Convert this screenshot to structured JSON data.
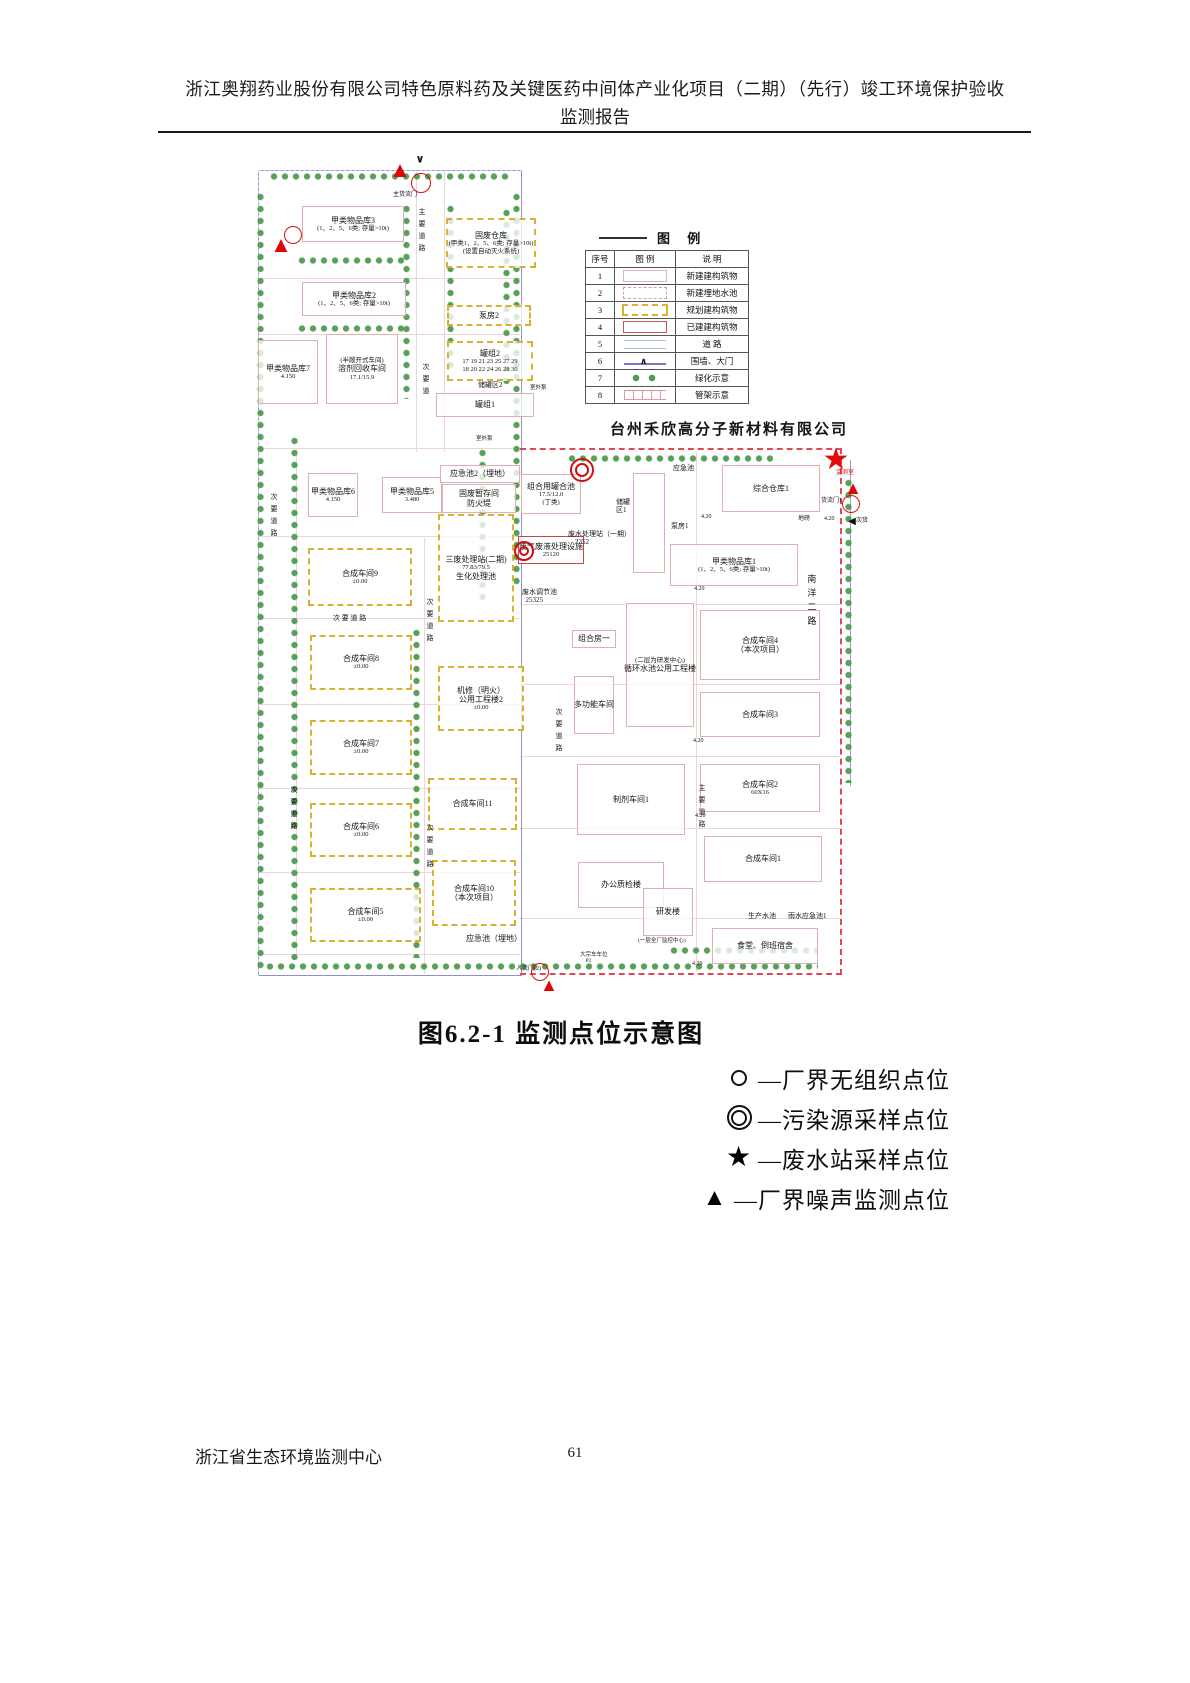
{
  "header": {
    "line1": "浙江奥翔药业股份有限公司特色原料药及关键医药中间体产业化项目（二期）（先行）竣工环境保护验收",
    "line2": "监测报告"
  },
  "caption": "图6.2-1  监测点位示意图",
  "footer": {
    "org": "浙江省生态环境监测中心",
    "page": "61"
  },
  "point_legend": [
    {
      "sym": "circle",
      "label": "—厂界无组织点位"
    },
    {
      "sym": "double",
      "label": "—污染源采样点位"
    },
    {
      "sym": "star",
      "label": "—废水站采样点位"
    },
    {
      "sym": "triangle",
      "label": "—厂界噪声监测点位"
    }
  ],
  "map": {
    "company": "台州禾欣高分子新材料有限公司",
    "colors": {
      "boundary_blue": "#8f8fca",
      "boundary_red": "#e04858",
      "planned_yellow": "#d6b232",
      "new_building_pink": "#dfb0b0",
      "existing_red": "#cc4444",
      "marker_red": "#dd1010",
      "tree_green": "#4f9b4f"
    },
    "legend": {
      "title": "图  例",
      "headers": [
        "序号",
        "图  例",
        "说  明"
      ],
      "rows": [
        {
          "n": "1",
          "s": "new",
          "d": "新建建构筑物"
        },
        {
          "n": "2",
          "s": "pool",
          "d": "新建埋地水池"
        },
        {
          "n": "3",
          "s": "planned",
          "d": "规划建构筑物"
        },
        {
          "n": "4",
          "s": "built",
          "d": "已建建构筑物"
        },
        {
          "n": "5",
          "s": "road",
          "d": "道  路"
        },
        {
          "n": "6",
          "s": "wall",
          "d": "围墙、大门"
        },
        {
          "n": "7",
          "s": "green",
          "d": "绿化示意"
        },
        {
          "n": "8",
          "s": "pipe",
          "d": "管架示意"
        }
      ]
    },
    "buildings": [
      {
        "x": 52,
        "y": 58,
        "w": 100,
        "h": 34,
        "st": "new",
        "ls": [
          "甲类物品库3",
          "(1、2、5、6类; 存量>10t)"
        ]
      },
      {
        "x": 196,
        "y": 70,
        "w": 86,
        "h": 46,
        "st": "planned",
        "ls": [
          "固废仓库",
          "(甲类1、2、5、6类; 存量>10t)",
          "(设置自动灭火系统)"
        ]
      },
      {
        "x": 52,
        "y": 134,
        "w": 102,
        "h": 32,
        "st": "new",
        "ls": [
          "甲类物品库2",
          "(1、2、5、6类; 存量>10t)"
        ]
      },
      {
        "x": 197,
        "y": 157,
        "w": 80,
        "h": 17,
        "st": "planned",
        "ls": [
          "泵房2"
        ]
      },
      {
        "x": 197,
        "y": 193,
        "w": 82,
        "h": 36,
        "st": "planned",
        "ls": [
          "罐组2",
          "17 19 21 23 25 27 29",
          "18 20 22 24 26 28 30"
        ]
      },
      {
        "x": 186,
        "y": 245,
        "w": 96,
        "h": 22,
        "st": "new",
        "ls": [
          "罐组1"
        ]
      },
      {
        "x": 8,
        "y": 192,
        "w": 58,
        "h": 62,
        "st": "new",
        "ls": [
          "甲类物品库7",
          "4.150"
        ]
      },
      {
        "x": 76,
        "y": 186,
        "w": 70,
        "h": 68,
        "st": "new",
        "ls": [
          "(半敞开式车间)",
          "溶剂回收车间",
          "17.1/15.9"
        ]
      },
      {
        "x": 58,
        "y": 325,
        "w": 48,
        "h": 42,
        "st": "new",
        "ls": [
          "甲类物品库6",
          "4.150"
        ]
      },
      {
        "x": 132,
        "y": 329,
        "w": 58,
        "h": 34,
        "st": "new",
        "ls": [
          "甲类物品库5",
          "3.480"
        ]
      },
      {
        "x": 190,
        "y": 317,
        "w": 78,
        "h": 16,
        "st": "new",
        "ls": [
          "应急池2（埋地）"
        ]
      },
      {
        "x": 192,
        "y": 336,
        "w": 72,
        "h": 27,
        "st": "new",
        "ls": [
          "固废暂存间",
          "防火堤"
        ]
      },
      {
        "x": 188,
        "y": 366,
        "w": 72,
        "h": 104,
        "st": "planned",
        "ls": [
          "三废处理站(二期)",
          "77.83/79.5",
          "生化处理池"
        ]
      },
      {
        "x": 58,
        "y": 400,
        "w": 100,
        "h": 54,
        "st": "planned",
        "ls": [
          "合成车间9",
          "±0.00"
        ]
      },
      {
        "x": 60,
        "y": 487,
        "w": 98,
        "h": 51,
        "st": "planned",
        "ls": [
          "合成车间8",
          "±0.00"
        ]
      },
      {
        "x": 60,
        "y": 572,
        "w": 98,
        "h": 51,
        "st": "planned",
        "ls": [
          "合成车间7",
          "±0.00"
        ]
      },
      {
        "x": 60,
        "y": 655,
        "w": 98,
        "h": 50,
        "st": "planned",
        "ls": [
          "合成车间6",
          "±0.00"
        ]
      },
      {
        "x": 60,
        "y": 740,
        "w": 107,
        "h": 50,
        "st": "planned",
        "ls": [
          "合成车间5",
          "±0.00"
        ]
      },
      {
        "x": 188,
        "y": 518,
        "w": 82,
        "h": 61,
        "st": "planned",
        "ls": [
          "机修（明火）",
          "公用工程楼2",
          "±0.00"
        ]
      },
      {
        "x": 178,
        "y": 630,
        "w": 85,
        "h": 48,
        "st": "planned",
        "ls": [
          "合成车间11"
        ]
      },
      {
        "x": 182,
        "y": 712,
        "w": 80,
        "h": 62,
        "st": "planned",
        "ls": [
          "合成车间10",
          "（本次项目）"
        ]
      },
      {
        "x": 196,
        "y": 783,
        "w": 96,
        "h": 16,
        "st": "plain",
        "ls": [
          "应急池（埋地）"
        ]
      },
      {
        "x": 472,
        "y": 317,
        "w": 96,
        "h": 45,
        "st": "new",
        "ls": [
          "综合仓库1"
        ]
      },
      {
        "x": 420,
        "y": 396,
        "w": 126,
        "h": 40,
        "st": "new",
        "ls": [
          "甲类物品库1",
          "(1、2、5、6类; 存量>10t)"
        ]
      },
      {
        "x": 450,
        "y": 462,
        "w": 118,
        "h": 68,
        "st": "new",
        "ls": [
          "合成车间4",
          "（本次项目）"
        ]
      },
      {
        "x": 450,
        "y": 544,
        "w": 118,
        "h": 43,
        "st": "new",
        "ls": [
          "合成车间3"
        ]
      },
      {
        "x": 450,
        "y": 616,
        "w": 118,
        "h": 46,
        "st": "new",
        "ls": [
          "合成车间2",
          "60X16"
        ]
      },
      {
        "x": 454,
        "y": 688,
        "w": 116,
        "h": 44,
        "st": "new",
        "ls": [
          "合成车间1"
        ]
      },
      {
        "x": 327,
        "y": 616,
        "w": 106,
        "h": 69,
        "st": "new",
        "ls": [
          "制剂车间1"
        ]
      },
      {
        "x": 324,
        "y": 528,
        "w": 38,
        "h": 56,
        "st": "new",
        "ls": [
          "多功能车间"
        ]
      },
      {
        "x": 376,
        "y": 455,
        "w": 66,
        "h": 122,
        "st": "new",
        "ls": [
          "(二层为研发中心)",
          "循环水池公用工程楼"
        ]
      },
      {
        "x": 322,
        "y": 482,
        "w": 42,
        "h": 16,
        "st": "new",
        "ls": [
          "组合房一"
        ]
      },
      {
        "x": 328,
        "y": 714,
        "w": 84,
        "h": 44,
        "st": "new",
        "ls": [
          "办公质检楼"
        ]
      },
      {
        "x": 393,
        "y": 740,
        "w": 48,
        "h": 46,
        "st": "new",
        "ls": [
          "研发楼"
        ]
      },
      {
        "x": 462,
        "y": 780,
        "w": 104,
        "h": 34,
        "st": "new",
        "ls": [
          "食堂、倒班宿舍"
        ]
      },
      {
        "x": 383,
        "y": 325,
        "w": 30,
        "h": 98,
        "st": "new",
        "ls": []
      },
      {
        "x": 271,
        "y": 326,
        "w": 58,
        "h": 38,
        "st": "new",
        "ls": [
          "组合用罐合池",
          "17.5/12.0",
          "(丁类)"
        ]
      },
      {
        "x": 268,
        "y": 388,
        "w": 64,
        "h": 26,
        "st": "existing",
        "ls": [
          "废气废液处理设施",
          "25120"
        ]
      }
    ],
    "labels": [
      {
        "t": "主货流门",
        "x": 143,
        "y": 44,
        "s": 6
      },
      {
        "t": "主要道路",
        "x": 168,
        "y": 60,
        "s": 7,
        "v": 1
      },
      {
        "t": "次要道",
        "x": 172,
        "y": 215,
        "s": 7,
        "v": 1
      },
      {
        "t": "次要道路",
        "x": 20,
        "y": 345,
        "s": 7,
        "v": 1
      },
      {
        "t": "次 要 道 路",
        "x": 83,
        "y": 466,
        "s": 7
      },
      {
        "t": "次要道路",
        "x": 176,
        "y": 450,
        "s": 7,
        "v": 1
      },
      {
        "t": "次要道路",
        "x": 40,
        "y": 638,
        "s": 7,
        "v": 1
      },
      {
        "t": "次要道路",
        "x": 176,
        "y": 676,
        "s": 7,
        "v": 1
      },
      {
        "t": "次要道路",
        "x": 305,
        "y": 560,
        "s": 7,
        "v": 1
      },
      {
        "t": "主要道路",
        "x": 448,
        "y": 636,
        "s": 7,
        "v": 1
      },
      {
        "t": "南洋二路",
        "x": 556,
        "y": 426,
        "s": 9,
        "v": 1
      },
      {
        "t": "储罐区2",
        "x": 228,
        "y": 233,
        "s": 7
      },
      {
        "t": "室外泵",
        "x": 280,
        "y": 237,
        "s": 5.5
      },
      {
        "t": "室外泵",
        "x": 226,
        "y": 288,
        "s": 5.5
      },
      {
        "t": "应急池",
        "x": 423,
        "y": 316,
        "s": 7
      },
      {
        "t": "泵房1",
        "x": 421,
        "y": 374,
        "s": 7
      },
      {
        "t": "储罐\n区1",
        "x": 366,
        "y": 350,
        "s": 7
      },
      {
        "t": "废水处理站（一期）\n    2352",
        "x": 318,
        "y": 382,
        "s": 7
      },
      {
        "t": "废水调节池\n  25325",
        "x": 272,
        "y": 440,
        "s": 7
      },
      {
        "t": "4.20",
        "x": 451,
        "y": 366,
        "s": 6
      },
      {
        "t": "地磅",
        "x": 548,
        "y": 368,
        "s": 6
      },
      {
        "t": "4.20",
        "x": 574,
        "y": 368,
        "s": 6
      },
      {
        "t": "4.20",
        "x": 444,
        "y": 438,
        "s": 6
      },
      {
        "t": "4.20",
        "x": 443,
        "y": 590,
        "s": 6
      },
      {
        "t": "4.20",
        "x": 445,
        "y": 665,
        "s": 6
      },
      {
        "t": "4.20",
        "x": 442,
        "y": 813,
        "s": 6
      },
      {
        "t": "监测室",
        "x": 586,
        "y": 322,
        "s": 6,
        "red": 1
      },
      {
        "t": "货流门1",
        "x": 571,
        "y": 350,
        "s": 6
      },
      {
        "t": "次货",
        "x": 606,
        "y": 370,
        "s": 6
      },
      {
        "t": "人流门(2)",
        "x": 266,
        "y": 818,
        "s": 6
      },
      {
        "t": "大宗车车位\n    P2",
        "x": 330,
        "y": 804,
        "s": 5.5
      },
      {
        "t": "生产水池",
        "x": 498,
        "y": 764,
        "s": 7
      },
      {
        "t": "雨水应急池1",
        "x": 538,
        "y": 764,
        "s": 7
      },
      {
        "t": "(一层全厂监控中心)",
        "x": 388,
        "y": 790,
        "s": 5.5
      }
    ],
    "markers": [
      {
        "ty": "tri",
        "x": 150,
        "y": 22,
        "s": 22
      },
      {
        "ty": "vdown",
        "x": 170,
        "y": 12
      },
      {
        "ty": "circ",
        "x": 171,
        "y": 35,
        "r": 9
      },
      {
        "ty": "tri",
        "x": 31,
        "y": 97,
        "s": 22
      },
      {
        "ty": "circ",
        "x": 43,
        "y": 87,
        "r": 8
      },
      {
        "ty": "dbl",
        "x": 332,
        "y": 322,
        "r": 10
      },
      {
        "ty": "dbl",
        "x": 274,
        "y": 403,
        "r": 8
      },
      {
        "ty": "star",
        "x": 586,
        "y": 312,
        "s": 30
      },
      {
        "ty": "tri",
        "x": 603,
        "y": 340,
        "s": 18
      },
      {
        "ty": "circ",
        "x": 601,
        "y": 356,
        "r": 8
      },
      {
        "ty": "circ",
        "x": 290,
        "y": 824,
        "r": 8
      },
      {
        "ty": "tri",
        "x": 299,
        "y": 837,
        "s": 18
      },
      {
        "ty": "left",
        "x": 602,
        "y": 374
      }
    ],
    "trees": [
      {
        "x": 20,
        "y": 24,
        "len": 240,
        "d": "h"
      },
      {
        "x": 6,
        "y": 44,
        "len": 778,
        "d": "v"
      },
      {
        "x": 152,
        "y": 56,
        "len": 195,
        "d": "v"
      },
      {
        "x": 196,
        "y": 56,
        "len": 165,
        "d": "v"
      },
      {
        "x": 48,
        "y": 108,
        "len": 110,
        "d": "h"
      },
      {
        "x": 48,
        "y": 176,
        "len": 110,
        "d": "h"
      },
      {
        "x": 262,
        "y": 44,
        "len": 395,
        "d": "v"
      },
      {
        "x": 252,
        "y": 60,
        "len": 180,
        "d": "v"
      },
      {
        "x": 228,
        "y": 300,
        "len": 158,
        "d": "v"
      },
      {
        "x": 40,
        "y": 288,
        "len": 530,
        "d": "v"
      },
      {
        "x": 162,
        "y": 480,
        "len": 330,
        "d": "v"
      },
      {
        "x": 318,
        "y": 306,
        "len": 205,
        "d": "h"
      },
      {
        "x": 594,
        "y": 330,
        "len": 305,
        "d": "v"
      },
      {
        "x": 16,
        "y": 814,
        "len": 552,
        "d": "h"
      },
      {
        "x": 420,
        "y": 798,
        "len": 148,
        "d": "h"
      }
    ],
    "roads": [
      {
        "x": 8,
        "y": 130,
        "len": 262,
        "d": "h"
      },
      {
        "x": 8,
        "y": 186,
        "len": 262,
        "d": "h"
      },
      {
        "x": 8,
        "y": 300,
        "len": 262,
        "d": "h"
      },
      {
        "x": 8,
        "y": 388,
        "len": 262,
        "d": "h"
      },
      {
        "x": 8,
        "y": 470,
        "len": 262,
        "d": "h"
      },
      {
        "x": 8,
        "y": 556,
        "len": 262,
        "d": "h"
      },
      {
        "x": 8,
        "y": 640,
        "len": 262,
        "d": "h"
      },
      {
        "x": 8,
        "y": 724,
        "len": 262,
        "d": "h"
      },
      {
        "x": 8,
        "y": 806,
        "len": 262,
        "d": "h"
      },
      {
        "x": 166,
        "y": 24,
        "len": 280,
        "d": "v"
      },
      {
        "x": 194,
        "y": 24,
        "len": 280,
        "d": "v"
      },
      {
        "x": 174,
        "y": 390,
        "len": 436,
        "d": "v"
      },
      {
        "x": 46,
        "y": 300,
        "len": 506,
        "d": "v"
      },
      {
        "x": 446,
        "y": 304,
        "len": 520,
        "d": "v"
      },
      {
        "x": 270,
        "y": 456,
        "len": 320,
        "d": "h"
      },
      {
        "x": 270,
        "y": 536,
        "len": 320,
        "d": "h"
      },
      {
        "x": 270,
        "y": 608,
        "len": 320,
        "d": "h"
      },
      {
        "x": 270,
        "y": 680,
        "len": 320,
        "d": "h"
      },
      {
        "x": 270,
        "y": 770,
        "len": 320,
        "d": "h"
      }
    ]
  }
}
